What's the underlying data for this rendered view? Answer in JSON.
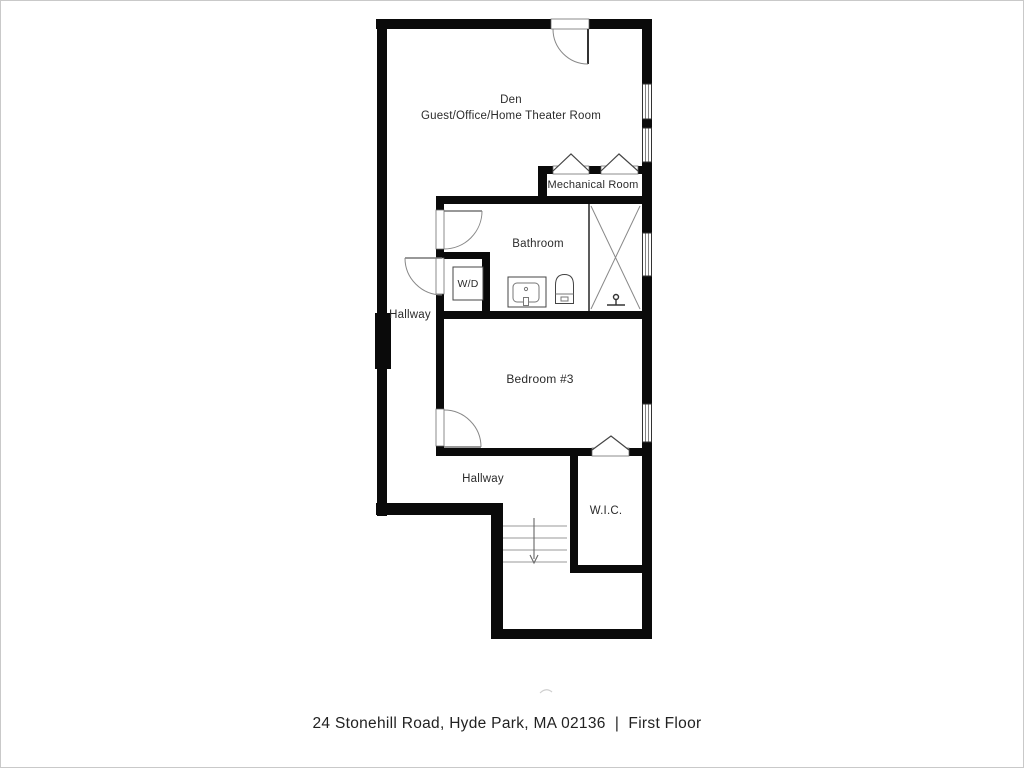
{
  "floor_plan": {
    "rooms": {
      "den": {
        "line1": "Den",
        "line2": "Guest/Office/Home Theater Room"
      },
      "mechanical": {
        "label": "Mechanical Room"
      },
      "bathroom": {
        "label": "Bathroom"
      },
      "washer_dryer": {
        "label": "W/D"
      },
      "hallway_upper": {
        "label": "Hallway"
      },
      "bedroom3": {
        "label": "Bedroom #3"
      },
      "hallway_lower": {
        "label": "Hallway"
      },
      "wic": {
        "label": "W.I.C."
      }
    },
    "caption": "24 Stonehill Road, Hyde Park, MA 02136  |  First Floor",
    "colors": {
      "wall": "#0a0a0a",
      "thin_line": "#555555",
      "fixture_line": "#777777",
      "label_text": "#2b2b2b",
      "background": "#ffffff"
    }
  }
}
